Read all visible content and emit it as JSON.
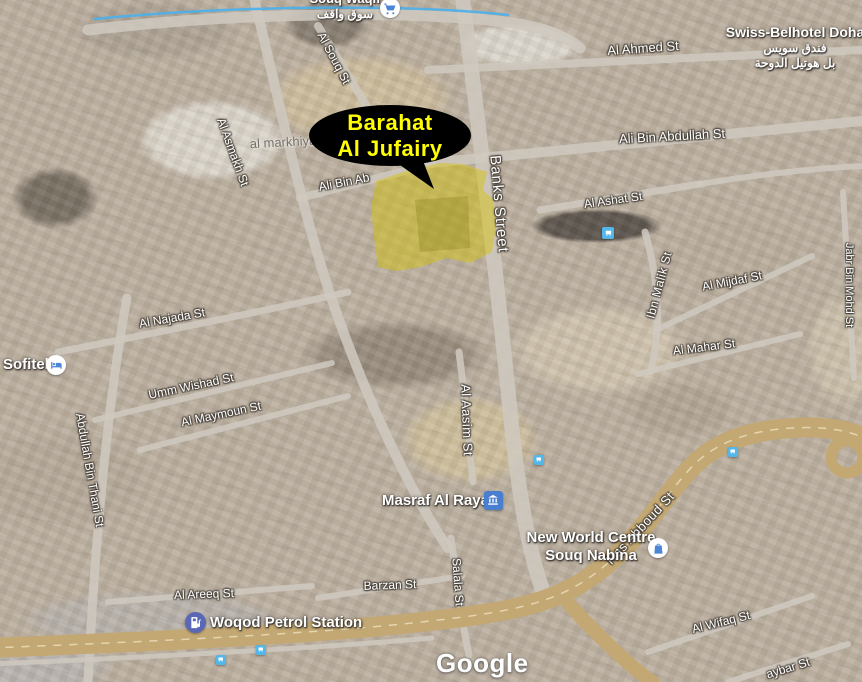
{
  "map": {
    "watermark": "Google",
    "callout": {
      "line1": "Barahat",
      "line2": "Al Jufairy",
      "text_color": "#ffff00",
      "bubble_color": "#000000"
    },
    "highlight_area": {
      "label": "Barahat Al Jufairy",
      "fill_color": "#d4c300"
    },
    "district_label": "al markhiya",
    "street_labels": [
      {
        "id": "al-souq-st",
        "text": "Al Souq St"
      },
      {
        "id": "al-ahmed-st",
        "text": "Al Ahmed St"
      },
      {
        "id": "ali-bin-abdullah-st",
        "text": "Ali Bin Abdullah St"
      },
      {
        "id": "al-asmakh-st",
        "text": "Al Asmakh St"
      },
      {
        "id": "ali-bin-ab",
        "text": "Ali Bin Ab"
      },
      {
        "id": "banks-street",
        "text": "Banks Street"
      },
      {
        "id": "al-ashat-st",
        "text": "Al Ashat St"
      },
      {
        "id": "ibn-malik-st",
        "text": "Ibn Malik St"
      },
      {
        "id": "al-mijdaf-st",
        "text": "Al Mijdaf St"
      },
      {
        "id": "al-mahar-st",
        "text": "Al Mahar St"
      },
      {
        "id": "jabr-bin-mohd-st",
        "text": "Jabr Bin Mohd St"
      },
      {
        "id": "al-najada-st",
        "text": "Al Najada St"
      },
      {
        "id": "umm-wishad-st",
        "text": "Umm Wishad St"
      },
      {
        "id": "al-maymoun-st",
        "text": "Al Maymoun St"
      },
      {
        "id": "abdullah-bin-thani-st",
        "text": "Abdullah Bin Thani St"
      },
      {
        "id": "al-aasim-st",
        "text": "Al Aasim St"
      },
      {
        "id": "al-areeq-st",
        "text": "Al Areeq St"
      },
      {
        "id": "barzan-st",
        "text": "Barzan St"
      },
      {
        "id": "salala-st",
        "text": "Salala St"
      },
      {
        "id": "ras-abboud-st",
        "text": "Ras Abboud St"
      },
      {
        "id": "al-wifaq-st",
        "text": "Al Wifaq St"
      },
      {
        "id": "aybar-st",
        "text": "aybar St"
      }
    ],
    "pois": [
      {
        "id": "souq-waqif",
        "lines": [
          "Souq Waqif",
          "سوق واقف"
        ],
        "icon": "cart-icon"
      },
      {
        "id": "swiss-belhotel",
        "lines": [
          "Swiss-Belhotel Doha",
          "فندق سويس",
          "بل هوتيل الدوحة"
        ],
        "icon": ""
      },
      {
        "id": "sofitel",
        "lines": [
          "Sofitel"
        ],
        "icon": "bed-icon"
      },
      {
        "id": "masraf-al-rayan",
        "lines": [
          "Masraf Al Rayan"
        ],
        "icon": "bank-icon"
      },
      {
        "id": "new-world-centre",
        "lines": [
          "New World Centre",
          "Souq Nabina"
        ],
        "icon": "bag-icon"
      },
      {
        "id": "woqod-petrol-station",
        "lines": [
          "Woqod Petrol Station"
        ],
        "icon": "fuel-icon"
      }
    ],
    "bus_stop_count": 5,
    "colors": {
      "poi_glyph_blue": "#4a85d8",
      "bus_icon_bg": "#53b7ea",
      "fuel_icon_bg": "#5a67b5",
      "bank_icon_bg": "#4a7fd0",
      "highway": "#c4a873",
      "transit_line": "#4ab0ec",
      "road": "#cfc9c0",
      "road_dash": "#ece0c0"
    }
  }
}
